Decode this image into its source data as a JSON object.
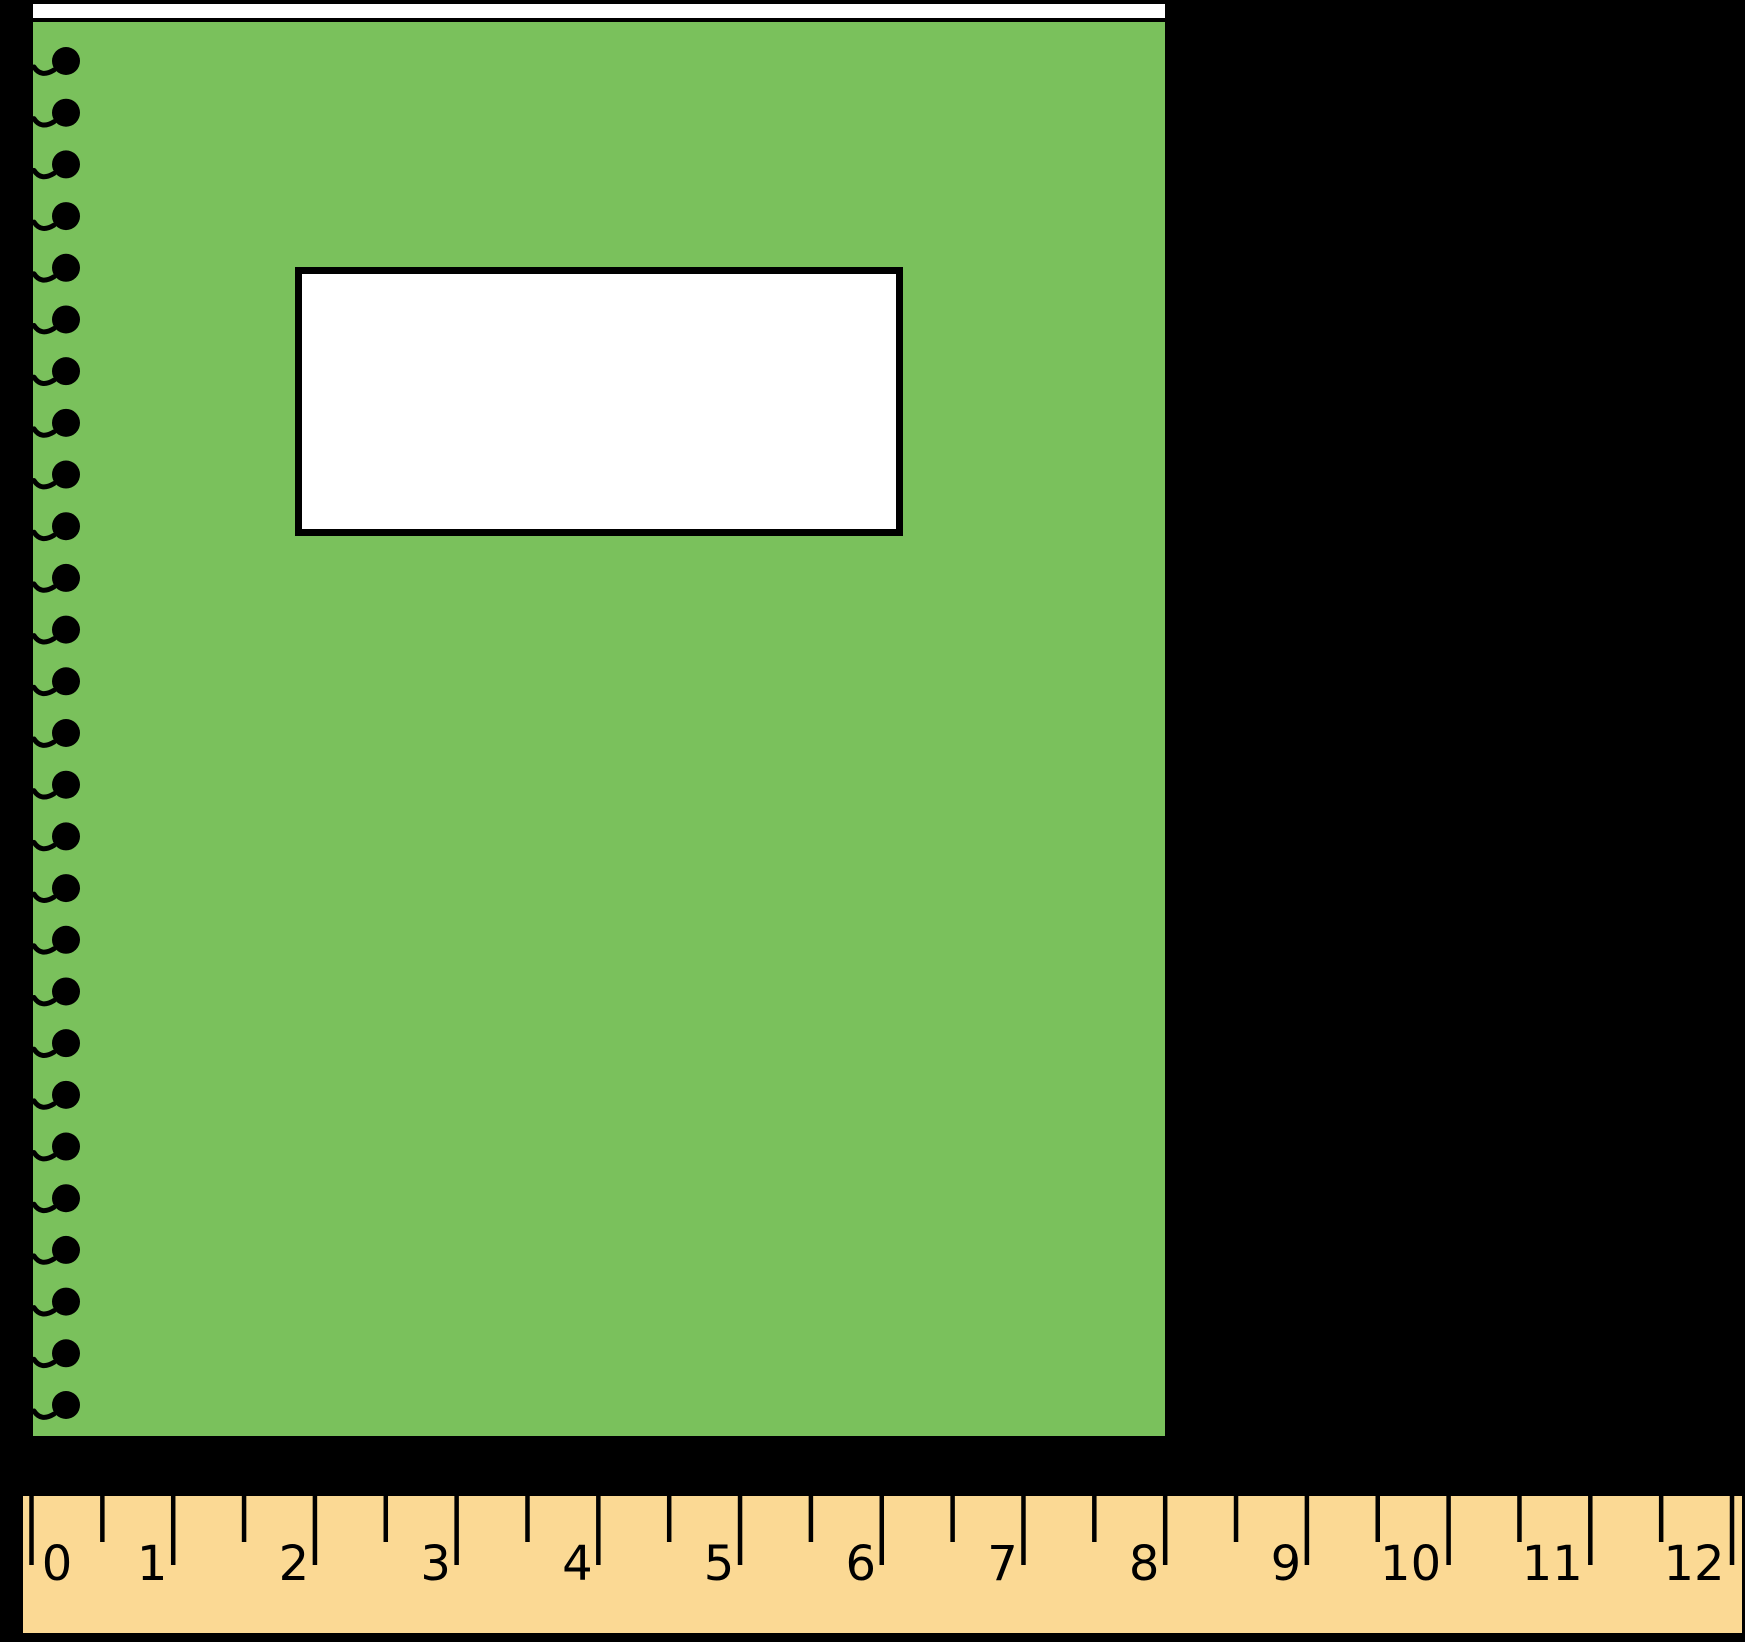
{
  "figure": {
    "colors": {
      "background": "#000000",
      "cover_green": "#7AC15C",
      "paper_white": "#FFFFFF",
      "ruler_tan": "#FBD994",
      "ink_black": "#000000"
    },
    "notebook": {
      "spiral": {
        "ring_count": 27
      }
    },
    "ruler": {
      "tick_labels": [
        "0",
        "1",
        "2",
        "3",
        "4",
        "5",
        "6",
        "7",
        "8",
        "9",
        "10",
        "11",
        "12"
      ]
    }
  }
}
